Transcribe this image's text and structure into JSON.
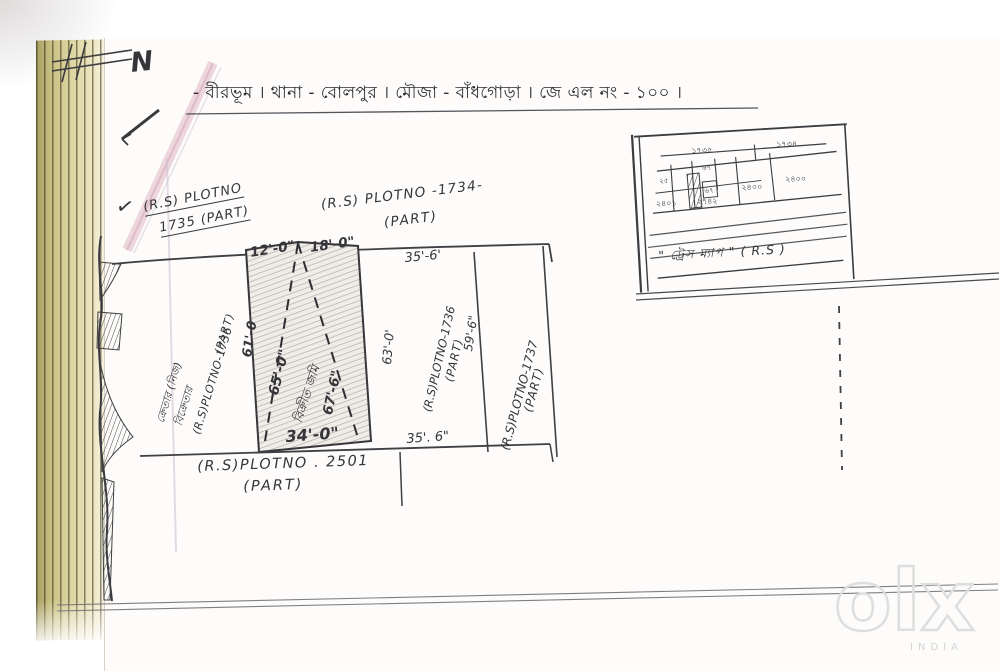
{
  "header": {
    "title": "- বীরভূম । থানা - বোলপুর । মৌজা - বাঁধগোড়া । জে এল নং - ১০০ ।"
  },
  "compass": {
    "letter": "N",
    "check": "✓"
  },
  "plot_labels": {
    "p1735": {
      "line1": "(R.S) PLOTNO",
      "line2": "1735 (PART)"
    },
    "p1734": {
      "line1": "(R.S) PLOTNO -1734-",
      "line2": "(PART)"
    },
    "p2501": {
      "line1": "(R.S)PLOTNO . 2501",
      "line2": "(PART)"
    },
    "left_strip": {
      "line1": "ক্রেতার (নিজ)",
      "line2": "বিক্রেতার",
      "line3": "(R.S)PLOTNO-1736",
      "line4": "(PART)"
    },
    "strip_1736": {
      "label": "(R.S)PLOTNO-1736",
      "part": "(PART)"
    },
    "strip_1737": {
      "label": "(R.S)PLOTNO-1737",
      "part": "(PART)"
    }
  },
  "central_plot": {
    "label": "বিক্রীত জমি"
  },
  "dimensions": {
    "top_left": "12'-0\"",
    "top_right": "18'-0\"",
    "left": "61'-0",
    "diag_left": "65'-0\"",
    "diag_right": "67'-6\"",
    "right": "63'-0'",
    "bottom": "34'-0\"",
    "strip_top": "35'-6'",
    "strip_side": "59'-6\"",
    "strip_bottom": "35'. 6\""
  },
  "inset": {
    "caption": "\" ট্রেস ম্যাপ \" ( R.S )",
    "numbers": {
      "top1": "১৭৩৫",
      "top2": "১৭৩৪",
      "c1": "২৫",
      "c2": "৬৭",
      "c3": "৬৭",
      "c4": "২৪০০",
      "c5": "২৪০০",
      "c6": "২৪০১",
      "c7": "২৭৪২"
    }
  },
  "watermark": {
    "brand": "olx",
    "country": "INDIA"
  }
}
